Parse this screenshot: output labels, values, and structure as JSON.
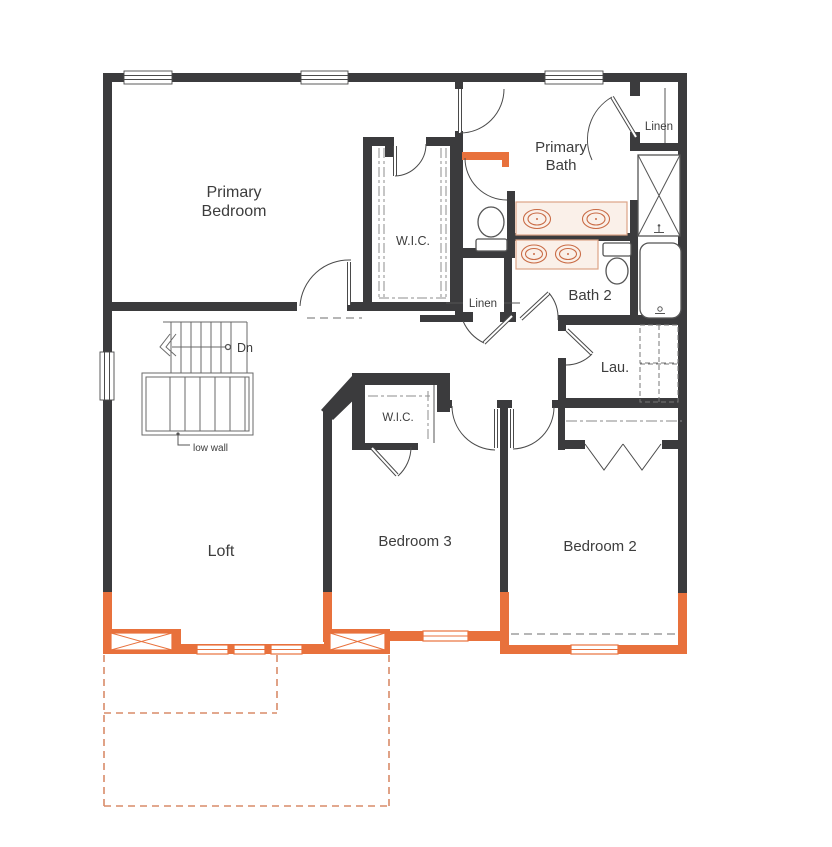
{
  "plan": {
    "type": "second-floor residential floor plan",
    "rooms": {
      "primary_bedroom": {
        "label_line1": "Primary",
        "label_line2": "Bedroom"
      },
      "primary_wic": {
        "label": "W.I.C."
      },
      "primary_bath": {
        "label_line1": "Primary",
        "label_line2": "Bath"
      },
      "linen_upper": {
        "label": "Linen"
      },
      "bath_2": {
        "label": "Bath 2"
      },
      "linen_hall": {
        "label": "Linen"
      },
      "laundry": {
        "label": "Lau."
      },
      "loft": {
        "label": "Loft"
      },
      "bedroom_3": {
        "label": "Bedroom 3"
      },
      "bedroom_2": {
        "label": "Bedroom 2"
      },
      "bedroom3_wic": {
        "label": "W.I.C."
      }
    },
    "annotations": {
      "stair_direction": "Dn",
      "stair_note": "low wall"
    },
    "fixtures_visible": [
      "dual-sink vanity (primary bath)",
      "dual-sink vanity (bath 2)",
      "toilet (primary water closet)",
      "toilet (bath 2)",
      "shower",
      "bathtub",
      "washer-dryer dashed boxes",
      "linen shelving",
      "L-shaped stairs",
      "bifold closet doors"
    ],
    "colors": {
      "wall_dark": "#3b3b3d",
      "option_orange": "#e8713c",
      "option_dashed_outline": "#d98b69",
      "fixture_outline": "#555555",
      "vanity_fill": "#faf0e9",
      "sink_outline": "#c96b45",
      "text": "#3d3d3d",
      "background": "#ffffff"
    }
  }
}
